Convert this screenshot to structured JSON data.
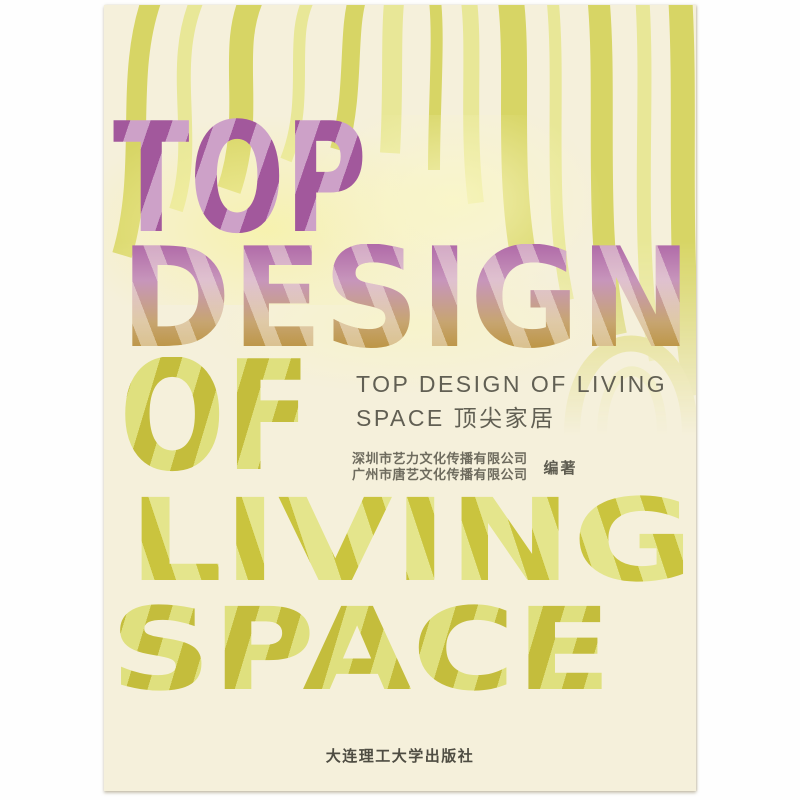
{
  "cover": {
    "title_words": [
      "TOP",
      "DESIGN",
      "OF",
      "LIVING",
      "SPACE"
    ],
    "subtitle": {
      "line1": "TOP DESIGN OF LIVING",
      "line2": "SPACE 顶尖家居"
    },
    "credits": {
      "line1": "深圳市艺力文化传播有限公司",
      "line2": "广州市唐艺文化传播有限公司",
      "role": "编著"
    },
    "publisher": "大连理工大学出版社",
    "colors": {
      "cover_cream": "#f5f0db",
      "stripe_olive": "#d7d565",
      "stripe_light_olive": "#e8e797",
      "letter_purple_dark": "#a2589c",
      "letter_purple_light": "#cda1c8",
      "letter_olive_dark": "#c4bd3c",
      "letter_olive_light": "#dfe07e",
      "design_gradient_top": "#b06aa8",
      "design_gradient_bottom": "#bd9646",
      "subtitle_gray": "#615f53",
      "publisher_gray": "#4e4c42"
    }
  }
}
